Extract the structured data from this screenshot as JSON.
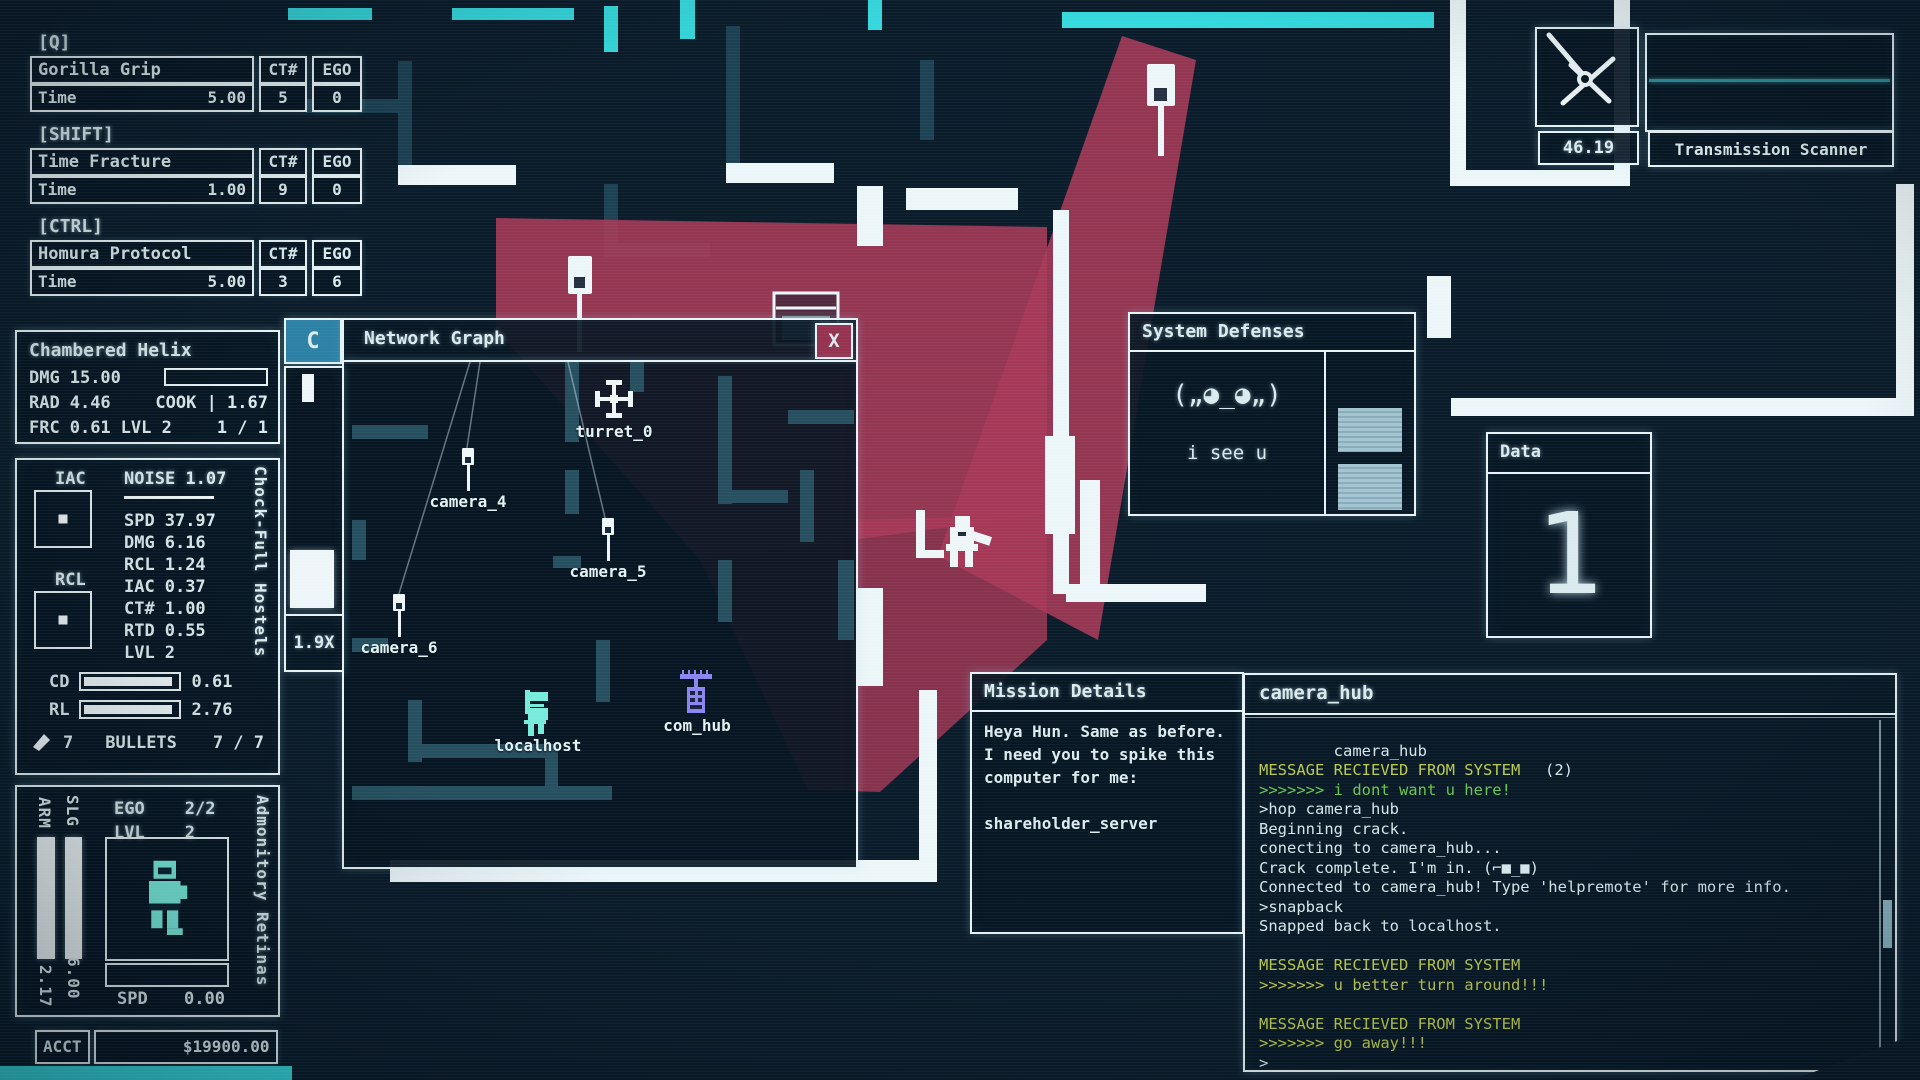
{
  "hotbar": {
    "slots": [
      {
        "key": "[Q]",
        "name": "Gorilla Grip",
        "ct_header": "CT#",
        "ego_header": "EGO",
        "stat_label": "Time",
        "stat_value": "5.00",
        "ct": "5",
        "ego": "0"
      },
      {
        "key": "[SHIFT]",
        "name": "Time Fracture",
        "ct_header": "CT#",
        "ego_header": "EGO",
        "stat_label": "Time",
        "stat_value": "1.00",
        "ct": "9",
        "ego": "0"
      },
      {
        "key": "[CTRL]",
        "name": "Homura Protocol",
        "ct_header": "CT#",
        "ego_header": "EGO",
        "stat_label": "Time",
        "stat_value": "5.00",
        "ct": "3",
        "ego": "6"
      }
    ]
  },
  "grenade": {
    "title": "Chambered Helix",
    "dmg_label": "DMG",
    "dmg_value": "15.00",
    "rad_label": "RAD",
    "rad_value": "4.46",
    "cook_text": "COOK | 1.67",
    "frc_label": "FRC",
    "frc_value": "0.61",
    "lvl_text": "LVL 2",
    "count": "1 / 1"
  },
  "weapon": {
    "vertical_name": "Chock-Full Hostels",
    "iac_label": "IAC",
    "rcl_label": "RCL",
    "noise_text": "NOISE 1.07",
    "stats": [
      {
        "label": "SPD",
        "value": "37.97"
      },
      {
        "label": "DMG",
        "value": "6.16"
      },
      {
        "label": "RCL",
        "value": "1.24"
      },
      {
        "label": "IAC",
        "value": "0.37"
      },
      {
        "label": "CT#",
        "value": "1.00"
      },
      {
        "label": "RTD",
        "value": "0.55"
      },
      {
        "label": "LVL",
        "value": "2"
      }
    ],
    "cd_label": "CD",
    "cd_value": "0.61",
    "rl_label": "RL",
    "rl_value": "2.76",
    "ammo_count": "7",
    "ammo_label": "BULLETS",
    "ammo_value": "7 / 7"
  },
  "armor": {
    "vertical_name": "Admonitory Retinas",
    "ego_label": "EGO",
    "ego_value": "2/2",
    "lvl_label": "LVL",
    "lvl_value": "2",
    "arm_label": "ARM",
    "arm_value": "2.17",
    "slg_label": "SLG",
    "slg_value": "6.00",
    "spd_label": "SPD",
    "spd_value": "0.00"
  },
  "account": {
    "label": "ACCT",
    "balance": "$19900.00"
  },
  "graph": {
    "collapse": "C",
    "title": "Network Graph",
    "close": "X",
    "zoom": "1.9X",
    "nodes": [
      {
        "label": "turret_0"
      },
      {
        "label": "camera_4"
      },
      {
        "label": "camera_5"
      },
      {
        "label": "camera_6"
      },
      {
        "label": "localhost"
      },
      {
        "label": "com_hub"
      }
    ]
  },
  "scanner": {
    "time": "46.19",
    "title": "Transmission Scanner"
  },
  "defenses": {
    "title": "System Defenses",
    "face": "(„◕_◕„)",
    "message": "i see u"
  },
  "data_panel": {
    "title": "Data",
    "value": "1"
  },
  "mission": {
    "title": "Mission Details",
    "lines": [
      "Heya Hun. Same as before.",
      "I need you to spike this",
      "computer for me:",
      "",
      "shareholder_server"
    ]
  },
  "terminal": {
    "title": "camera_hub",
    "host": "camera_hub",
    "tabs": "(2)",
    "lines": [
      {
        "text": "",
        "cls": "white"
      },
      {
        "text": "MESSAGE RECIEVED FROM SYSTEM",
        "cls": "yellow"
      },
      {
        "text": ">>>>>>> i dont want u here!",
        "cls": "green"
      },
      {
        "text": ">hop camera_hub",
        "cls": "white"
      },
      {
        "text": "Beginning crack.",
        "cls": "white"
      },
      {
        "text": "conecting to camera_hub...",
        "cls": "white"
      },
      {
        "text": "Crack complete. I'm in. (⌐■_■)",
        "cls": "white"
      },
      {
        "text": "Connected to camera_hub! Type 'helpremote' for more info.",
        "cls": "white"
      },
      {
        "text": ">snapback",
        "cls": "white"
      },
      {
        "text": "Snapped back to localhost.",
        "cls": "white"
      },
      {
        "text": "",
        "cls": "white"
      },
      {
        "text": "MESSAGE RECIEVED FROM SYSTEM",
        "cls": "yellow"
      },
      {
        "text": ">>>>>>> u better turn around!!!",
        "cls": "yellow"
      },
      {
        "text": "",
        "cls": "white"
      },
      {
        "text": "MESSAGE RECIEVED FROM SYSTEM",
        "cls": "yellow"
      },
      {
        "text": ">>>>>>> go away!!!",
        "cls": "yellow"
      },
      {
        "text": ">",
        "cls": "white"
      }
    ]
  }
}
